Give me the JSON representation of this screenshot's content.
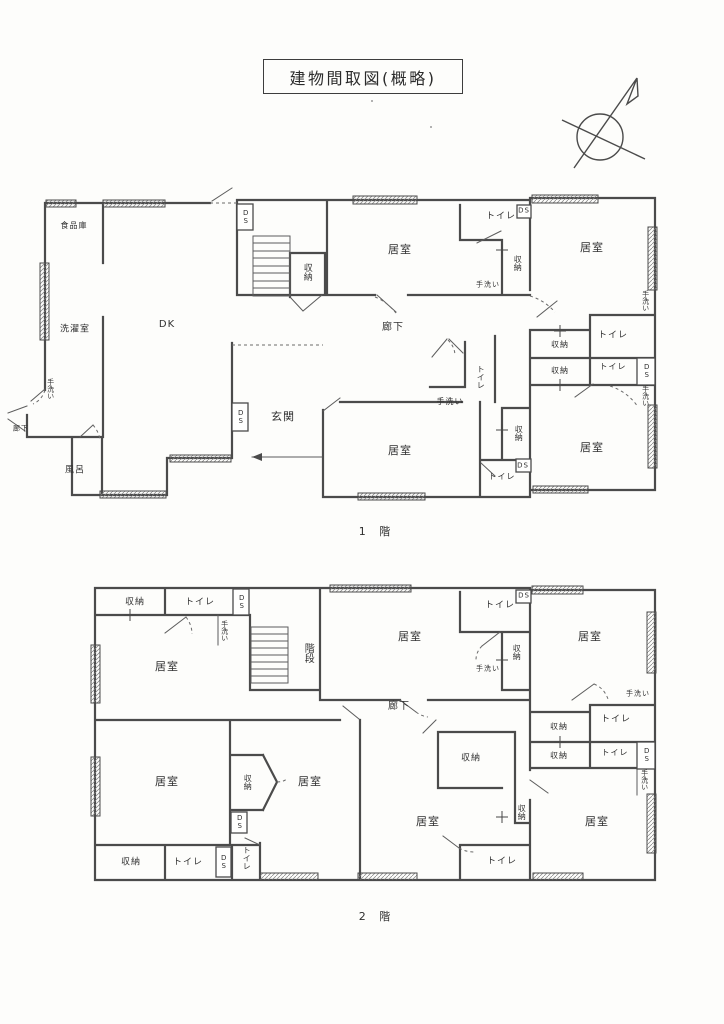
{
  "title": "建物間取図(概略)",
  "icons": {
    "compass": "north-compass-icon"
  },
  "floor1": {
    "caption": "1 階",
    "labels": [
      {
        "id": "pantry",
        "t": "食品庫"
      },
      {
        "id": "laundry",
        "t": "洗濯室"
      },
      {
        "id": "dk",
        "t": "DK"
      },
      {
        "id": "handwash-left",
        "t": "手洗い"
      },
      {
        "id": "corridor-left",
        "t": "廊下"
      },
      {
        "id": "bath",
        "t": "風呂"
      },
      {
        "id": "ds-top",
        "t": "DS"
      },
      {
        "id": "closet-stairs",
        "t": "収納"
      },
      {
        "id": "room-top-center",
        "t": "居室"
      },
      {
        "id": "corridor",
        "t": "廊下"
      },
      {
        "id": "toilet-top-right",
        "t": "トイレ"
      },
      {
        "id": "ds-top-right",
        "t": "DS"
      },
      {
        "id": "closet-top-right",
        "t": "収納"
      },
      {
        "id": "handwash-top-right",
        "t": "手洗い"
      },
      {
        "id": "room-top-right",
        "t": "居室"
      },
      {
        "id": "handwash-right-upper",
        "t": "手洗い"
      },
      {
        "id": "closet-right-row1",
        "t": "収納"
      },
      {
        "id": "toilet-right-row1",
        "t": "トイレ"
      },
      {
        "id": "closet-right-row2",
        "t": "収納"
      },
      {
        "id": "toilet-right-row2",
        "t": "トイレ"
      },
      {
        "id": "ds-right-row2",
        "t": "DS"
      },
      {
        "id": "handwash-right-lower",
        "t": "手洗い"
      },
      {
        "id": "toilet-center",
        "t": "トイレ"
      },
      {
        "id": "handwash-center",
        "t": "手洗い"
      },
      {
        "id": "entrance",
        "t": "玄関"
      },
      {
        "id": "ds-entrance",
        "t": "DS"
      },
      {
        "id": "closet-mid",
        "t": "収納"
      },
      {
        "id": "room-bottom-center",
        "t": "居室"
      },
      {
        "id": "ds-bottom",
        "t": "DS"
      },
      {
        "id": "toilet-bottom",
        "t": "トイレ"
      },
      {
        "id": "room-bottom-right",
        "t": "居室"
      }
    ]
  },
  "floor2": {
    "caption": "2 階",
    "labels": [
      {
        "id": "closet-top-left",
        "t": "収納"
      },
      {
        "id": "toilet-top-left",
        "t": "トイレ"
      },
      {
        "id": "ds-top-left",
        "t": "DS"
      },
      {
        "id": "handwash-top-left",
        "t": "手洗い"
      },
      {
        "id": "stairs",
        "t": "階段"
      },
      {
        "id": "room-top-left",
        "t": "居室"
      },
      {
        "id": "room-top-center",
        "t": "居室"
      },
      {
        "id": "toilet-top-right",
        "t": "トイレ"
      },
      {
        "id": "ds-top-right",
        "t": "DS"
      },
      {
        "id": "closet-top-right",
        "t": "収納"
      },
      {
        "id": "handwash-top-right",
        "t": "手洗い"
      },
      {
        "id": "room-top-right",
        "t": "居室"
      },
      {
        "id": "corridor",
        "t": "廊下"
      },
      {
        "id": "handwash-right-upper",
        "t": "手洗い"
      },
      {
        "id": "closet-right-row1",
        "t": "収納"
      },
      {
        "id": "toilet-right-row1",
        "t": "トイレ"
      },
      {
        "id": "closet-right-row2",
        "t": "収納"
      },
      {
        "id": "toilet-right-row2",
        "t": "トイレ"
      },
      {
        "id": "ds-right-row2",
        "t": "DS"
      },
      {
        "id": "handwash-right-lower",
        "t": "手洗い"
      },
      {
        "id": "room-bottom-left",
        "t": "居室"
      },
      {
        "id": "closet-pentagon",
        "t": "収納"
      },
      {
        "id": "room-bottom-midleft",
        "t": "居室"
      },
      {
        "id": "ds-mid",
        "t": "DS"
      },
      {
        "id": "closet-bottom-center-top",
        "t": "収納"
      },
      {
        "id": "room-bottom-center",
        "t": "居室"
      },
      {
        "id": "closet-bottom-center-right",
        "t": "収納"
      },
      {
        "id": "closet-bottom-strip",
        "t": "収納"
      },
      {
        "id": "toilet-bottom-strip",
        "t": "トイレ"
      },
      {
        "id": "ds-bottom-strip",
        "t": "DS"
      },
      {
        "id": "toilet-bottom-strip-2",
        "t": "トイレ"
      },
      {
        "id": "toilet-bottom-center",
        "t": "トイレ"
      },
      {
        "id": "room-bottom-right",
        "t": "居室"
      }
    ]
  }
}
